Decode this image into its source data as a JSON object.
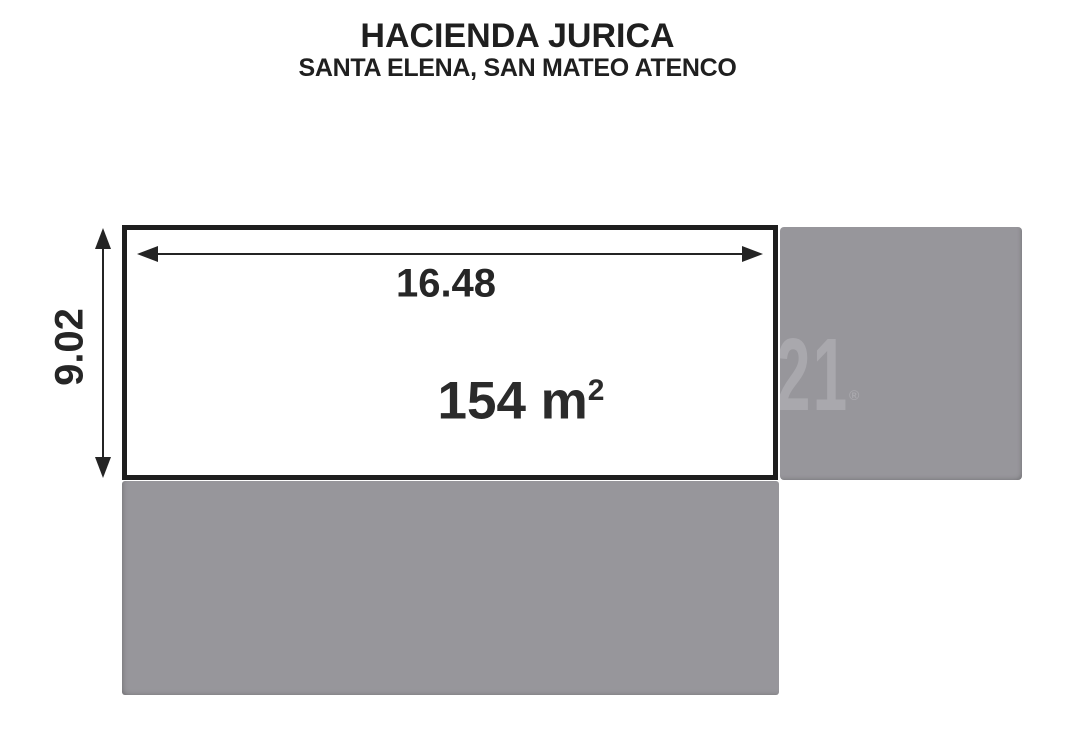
{
  "header": {
    "title": "HACIENDA JURICA",
    "subtitle": "SANTA ELENA, SAN MATEO ATENCO"
  },
  "lot": {
    "width_label": "16.48",
    "depth_label": "9.02",
    "area_value": "154 m",
    "area_exponent": "2"
  },
  "watermark": {
    "number": "21",
    "registered_symbol": "®"
  },
  "colors": {
    "neighbor_block_gray": "#97969b",
    "watermark_gray": "#a9a8ad",
    "line_black": "#242424",
    "lot_border_black": "#1e1e1e",
    "background": "#ffffff"
  }
}
